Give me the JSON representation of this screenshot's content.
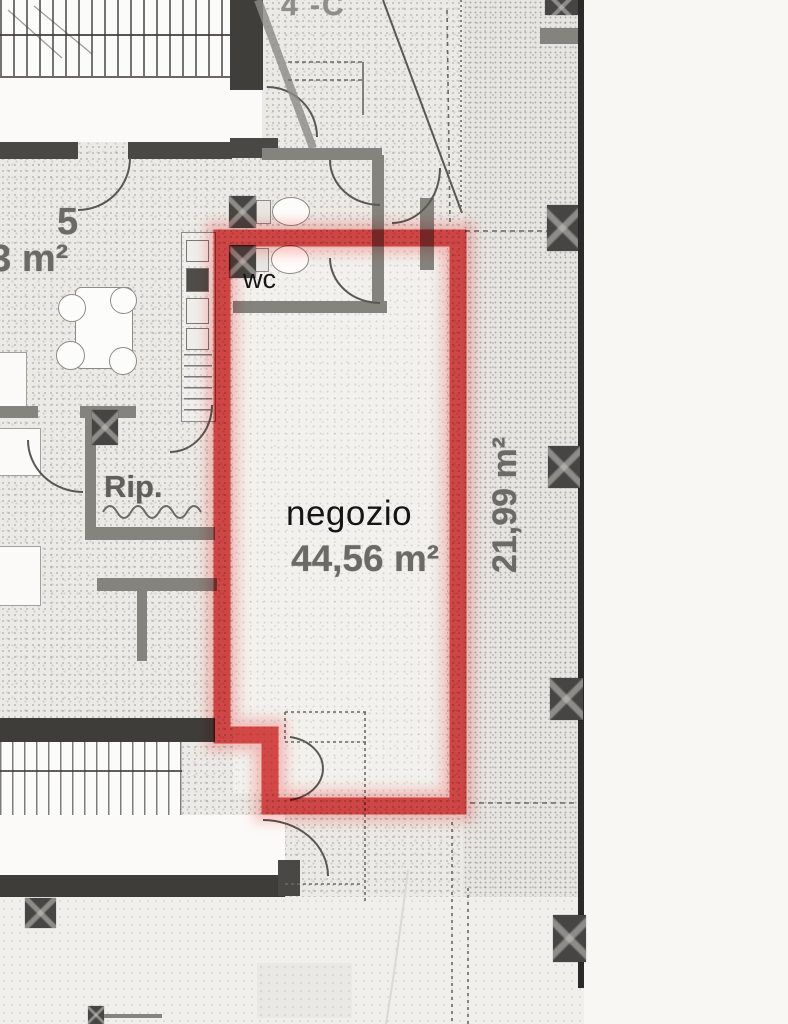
{
  "labels": {
    "unit": "4 -C",
    "apartment_number": "5",
    "apartment_area": "63 m²",
    "wc": "wc",
    "storage": "Rip.",
    "shop_name": "negozio",
    "shop_area": "44,56 m²",
    "outdoor_area": "21,99 m²"
  },
  "colors": {
    "highlight_red": "#d93636",
    "highlight_glow": "#ff6a6a",
    "wall_dark": "#4a4845",
    "wall_medium": "#85837d",
    "plan_background": "#eceae6",
    "paper_white": "#f8f7f4"
  }
}
